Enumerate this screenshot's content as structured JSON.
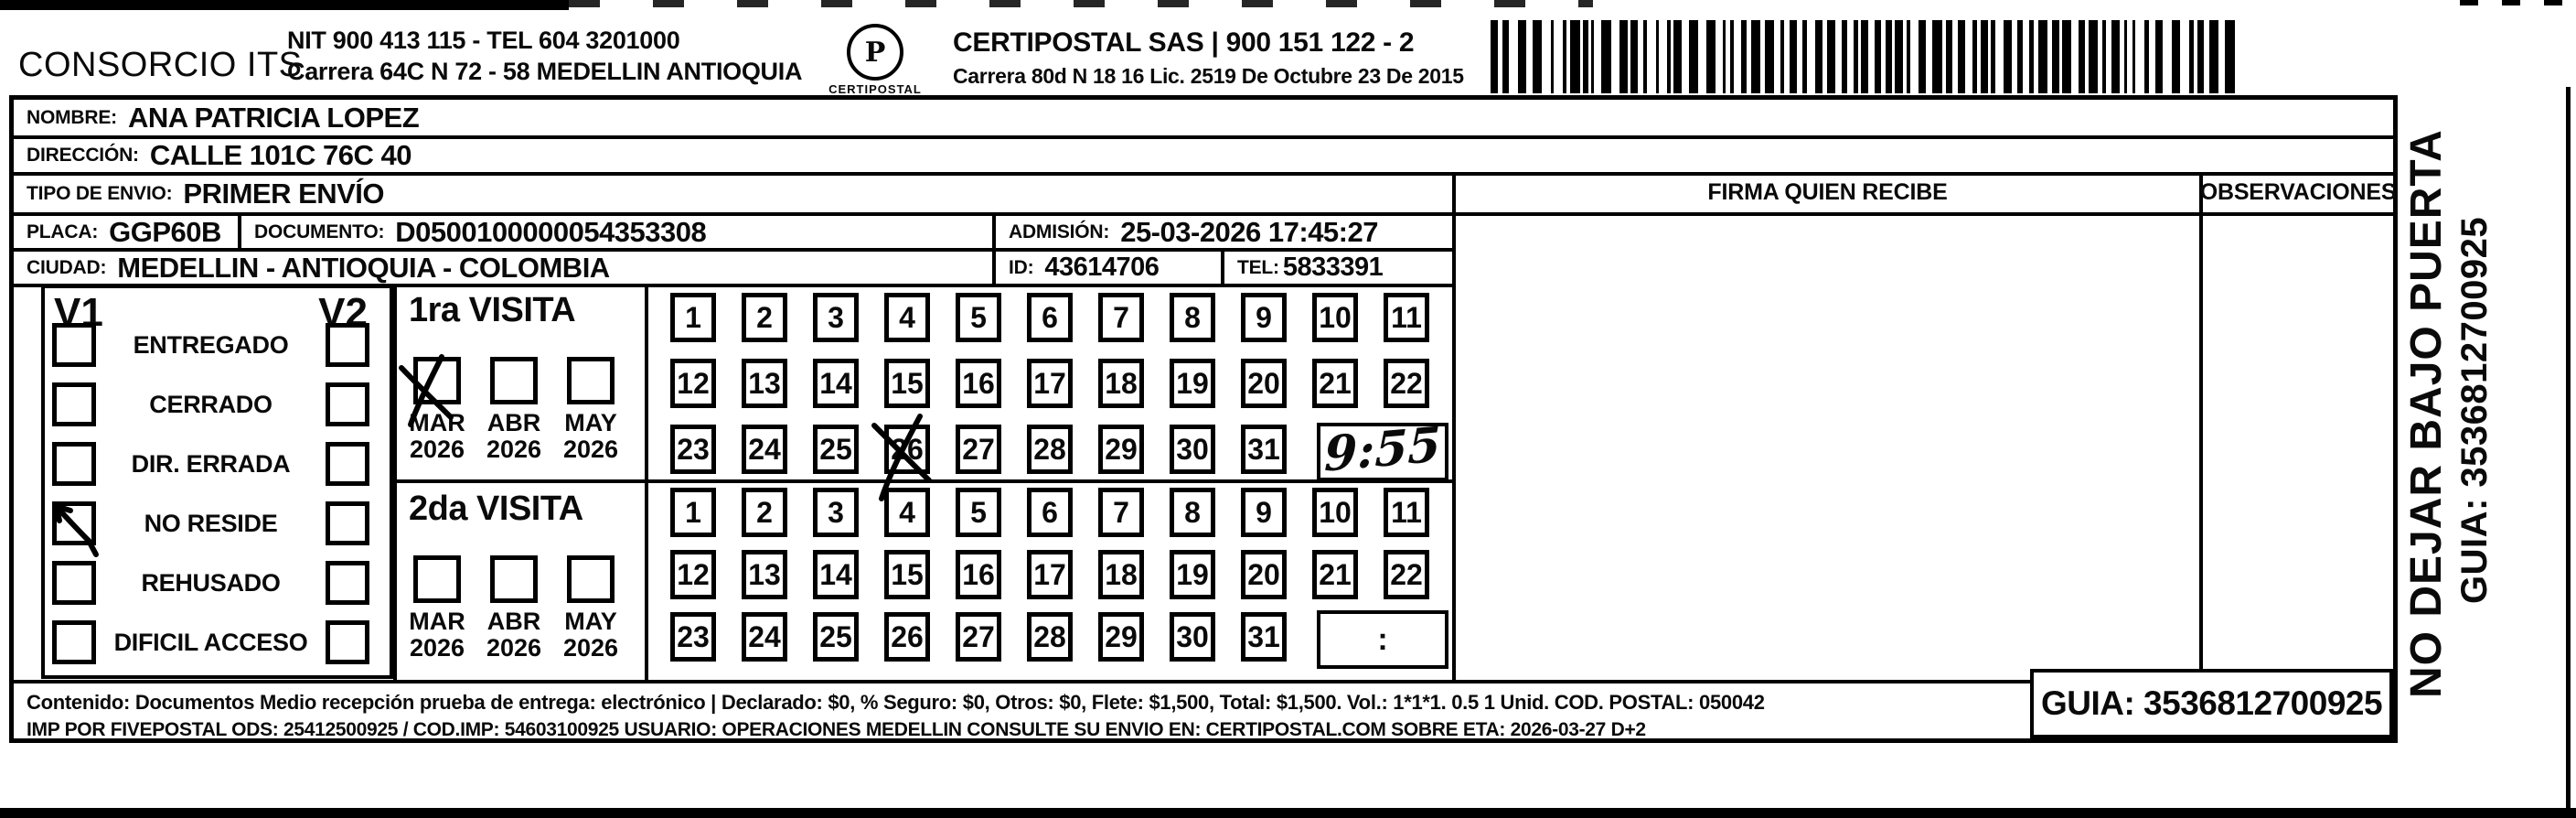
{
  "header": {
    "company_name": "CONSORCIO ITS",
    "company_nit_line": "NIT 900 413 115 - TEL 604 3201000",
    "company_address_line": "Carrera 64C N 72 - 58 MEDELLIN ANTIOQUIA",
    "logo_name": "CERTIPOSTAL",
    "logo_glyph": "P",
    "carrier_title": "CERTIPOSTAL SAS | 900 151 122 - 2",
    "carrier_address_line": "Carrera 80d N 18 16  Lic. 2519 De Octubre 23 De 2015"
  },
  "shipment": {
    "nombre_label": "NOMBRE:",
    "nombre": "ANA PATRICIA LOPEZ",
    "direccion_label": "DIRECCIÓN:",
    "direccion": "CALLE 101C 76C 40",
    "tipo_envio_label": "TIPO DE ENVIO:",
    "tipo_envio": "PRIMER ENVÍO",
    "placa_label": "PLACA:",
    "placa": "GGP60B",
    "documento_label": "DOCUMENTO:",
    "documento": "D0500100000054353308",
    "admision_label": "ADMISIÓN:",
    "admision": "25-03-2026 17:45:27",
    "ciudad_label": "CIUDAD:",
    "ciudad": "MEDELLIN - ANTIOQUIA - COLOMBIA",
    "id_label": "ID:",
    "id_value": "43614706",
    "tel_label": "TEL:",
    "tel": "5833391"
  },
  "status_panel": {
    "visit1_header": "V1",
    "visit2_header": "V2",
    "rows": [
      {
        "label": "ENTREGADO",
        "v1_checked": false,
        "v2_checked": false
      },
      {
        "label": "CERRADO",
        "v1_checked": false,
        "v2_checked": false
      },
      {
        "label": "DIR. ERRADA",
        "v1_checked": false,
        "v2_checked": false
      },
      {
        "label": "NO RESIDE",
        "v1_checked": true,
        "v2_checked": false
      },
      {
        "label": "REHUSADO",
        "v1_checked": false,
        "v2_checked": false
      },
      {
        "label": "DIFICIL ACCESO",
        "v1_checked": false,
        "v2_checked": false
      }
    ]
  },
  "visits": [
    {
      "title": "1ra VISITA",
      "months": [
        {
          "month": "MAR",
          "year": "2026",
          "checked": true
        },
        {
          "month": "ABR",
          "year": "2026",
          "checked": false
        },
        {
          "month": "MAY",
          "year": "2026",
          "checked": false
        }
      ],
      "day_rows": [
        [
          1,
          2,
          3,
          4,
          5,
          6,
          7,
          8,
          9,
          10,
          11
        ],
        [
          12,
          13,
          14,
          15,
          16,
          17,
          18,
          19,
          20,
          21,
          22
        ],
        [
          23,
          24,
          25,
          26,
          27,
          28,
          29,
          30,
          31
        ]
      ],
      "marked_day": 26,
      "time_written": "9:55"
    },
    {
      "title": "2da VISITA",
      "months": [
        {
          "month": "MAR",
          "year": "2026",
          "checked": false
        },
        {
          "month": "ABR",
          "year": "2026",
          "checked": false
        },
        {
          "month": "MAY",
          "year": "2026",
          "checked": false
        }
      ],
      "day_rows": [
        [
          1,
          2,
          3,
          4,
          5,
          6,
          7,
          8,
          9,
          10,
          11
        ],
        [
          12,
          13,
          14,
          15,
          16,
          17,
          18,
          19,
          20,
          21,
          22
        ],
        [
          23,
          24,
          25,
          26,
          27,
          28,
          29,
          30,
          31
        ]
      ],
      "marked_day": null,
      "time_written": ":"
    }
  ],
  "signature": {
    "firma_header": "FIRMA QUIEN RECIBE",
    "observaciones_header": "OBSERVACIONES"
  },
  "footer": {
    "line1": "Contenido: Documentos Medio recepción prueba de entrega: electrónico | Declarado: $0, % Seguro: $0, Otros: $0, Flete: $1,500, Total: $1,500. Vol.: 1*1*1. 0.5  1 Unid. COD. POSTAL: 050042",
    "line2": "IMP POR FIVEPOSTAL ODS: 25412500925 / COD.IMP: 54603100925 USUARIO: OPERACIONES MEDELLIN CONSULTE SU ENVIO EN: CERTIPOSTAL.COM SOBRE ETA: 2026-03-27 D+2",
    "guia_box": "GUIA: 3536812700925"
  },
  "sidebar": {
    "warning": "NO DEJAR BAJO PUERTA",
    "guia": "GUIA: 3536812700925"
  }
}
